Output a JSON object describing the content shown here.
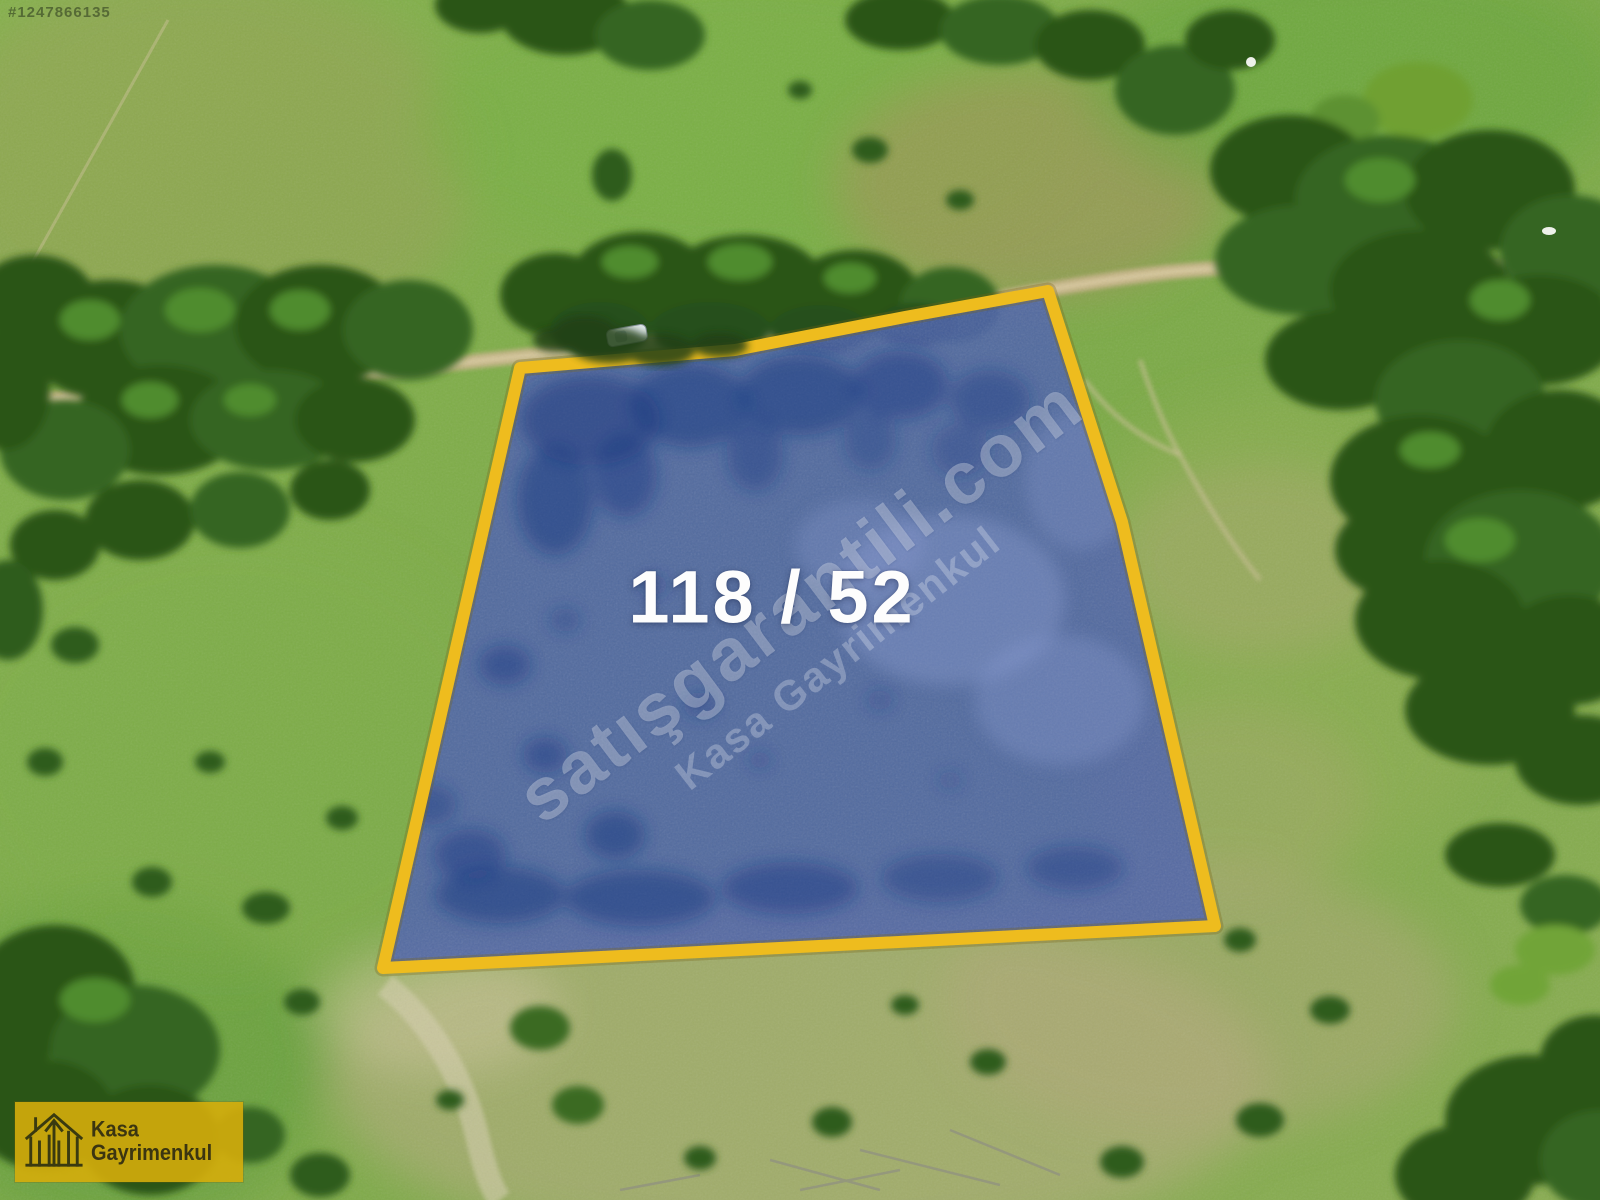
{
  "photo": {
    "parcel_label": "118 / 52",
    "photo_id": "#1247866135"
  },
  "watermarks": {
    "primary": "satışgarantili.com",
    "secondary": "Kasa Gayrimenkul"
  },
  "logo": {
    "name": "Kasa Gayrimenkul"
  },
  "colors": {
    "parcel_fill_blue": "#4a5fae",
    "parcel_shadow_blue": "#1c3880",
    "parcel_border_yellow": "#eebc1e",
    "parcel_label_white": "#fdfdfd",
    "watermark_white": "rgba(255,255,255,0.30)",
    "logo_background": "#d5ad0b",
    "logo_text": "#3b3511",
    "grass_green": "#7cab47",
    "dry_grass_tan": "#b6ad80",
    "tree_dark_green": "#2c5719",
    "road_tan": "#c8b488"
  }
}
